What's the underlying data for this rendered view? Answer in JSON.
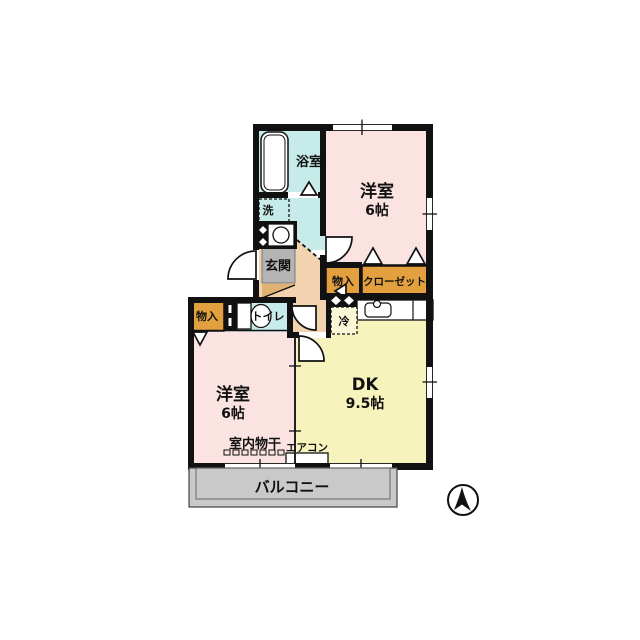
{
  "floor_plan": {
    "rooms": {
      "bathroom": {
        "label": "浴室"
      },
      "laundry": {
        "label": "洗"
      },
      "entrance": {
        "label": "玄関"
      },
      "bedroom_top": {
        "label": "洋室",
        "size": "6帖"
      },
      "storage_top": {
        "label": "物入"
      },
      "closet": {
        "label": "クローゼット"
      },
      "fridge_space": {
        "label": "冷"
      },
      "toilet": {
        "label": "トイレ"
      },
      "storage_bottom": {
        "label": "物入"
      },
      "bedroom_bottom": {
        "label": "洋室",
        "size": "6帖"
      },
      "dining_kitchen": {
        "label": "DK",
        "size": "9.5帖"
      },
      "indoor_drying": {
        "label": "室内物干"
      },
      "aircon": {
        "label": "エアコン"
      },
      "balcony": {
        "label": "バルコニー"
      }
    }
  },
  "colors": {
    "wet_area": "#c7ebe8",
    "bedroom": "#fae3e1",
    "dk": "#f7f3bc",
    "storage": "#e2a13e",
    "hallway": "#f3d2b0",
    "entrance_gray": "#b4b4b4",
    "shoebox_tan": "#e0b273",
    "balcony_gray": "#c9c9c9",
    "fridge_fill": "#fbf8d8",
    "wall": "#111111"
  }
}
